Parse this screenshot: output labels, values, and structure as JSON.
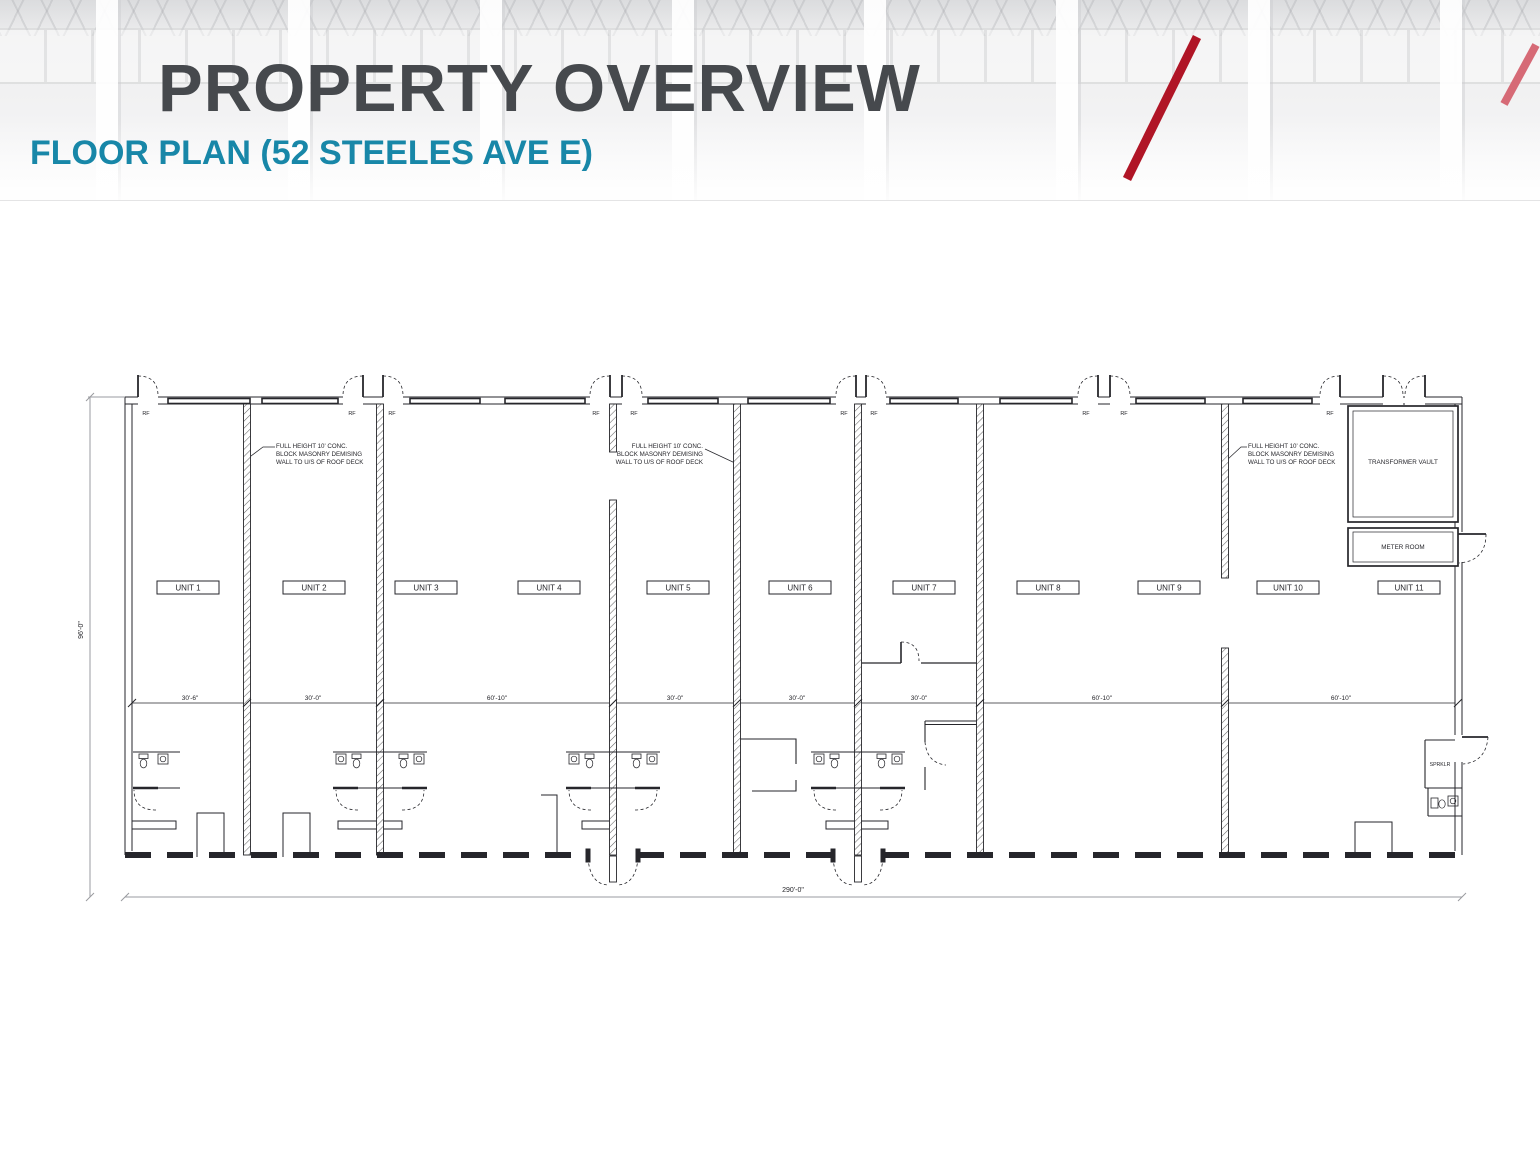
{
  "slide": {
    "title": "PROPERTY OVERVIEW",
    "subtitle": "FLOOR PLAN (52 STEELES AVE E)",
    "colors": {
      "title": "#46494d",
      "subtitle": "#1887a8",
      "accent_dark": "#b01526",
      "accent_light": "#d66a76"
    }
  },
  "floor_plan": {
    "unit_labels": [
      "UNIT 1",
      "UNIT 2",
      "UNIT 3",
      "UNIT 4",
      "UNIT 5",
      "UNIT 6",
      "UNIT 7",
      "UNIT 8",
      "UNIT 9",
      "UNIT 10",
      "UNIT 11"
    ],
    "room_labels": {
      "transformer_vault": "TRANSFORMER VAULT",
      "meter_room": "METER ROOM",
      "sprinkler_room": "SPRKLR"
    },
    "masonry_note_lines": [
      "FULL HEIGHT 10' CONC.",
      "BLOCK MASONRY DEMISING",
      "WALL TO U/S OF ROOF DECK"
    ],
    "door_label": "RF",
    "dimensions": {
      "bay_widths": [
        "30'-6\"",
        "30'-0\"",
        "60'-10\"",
        "30'-0\"",
        "30'-0\"",
        "30'-0\"",
        "60'-10\"",
        "60'-10\""
      ],
      "overall_width": "290'-0\"",
      "overall_depth": "96'-0\""
    }
  }
}
